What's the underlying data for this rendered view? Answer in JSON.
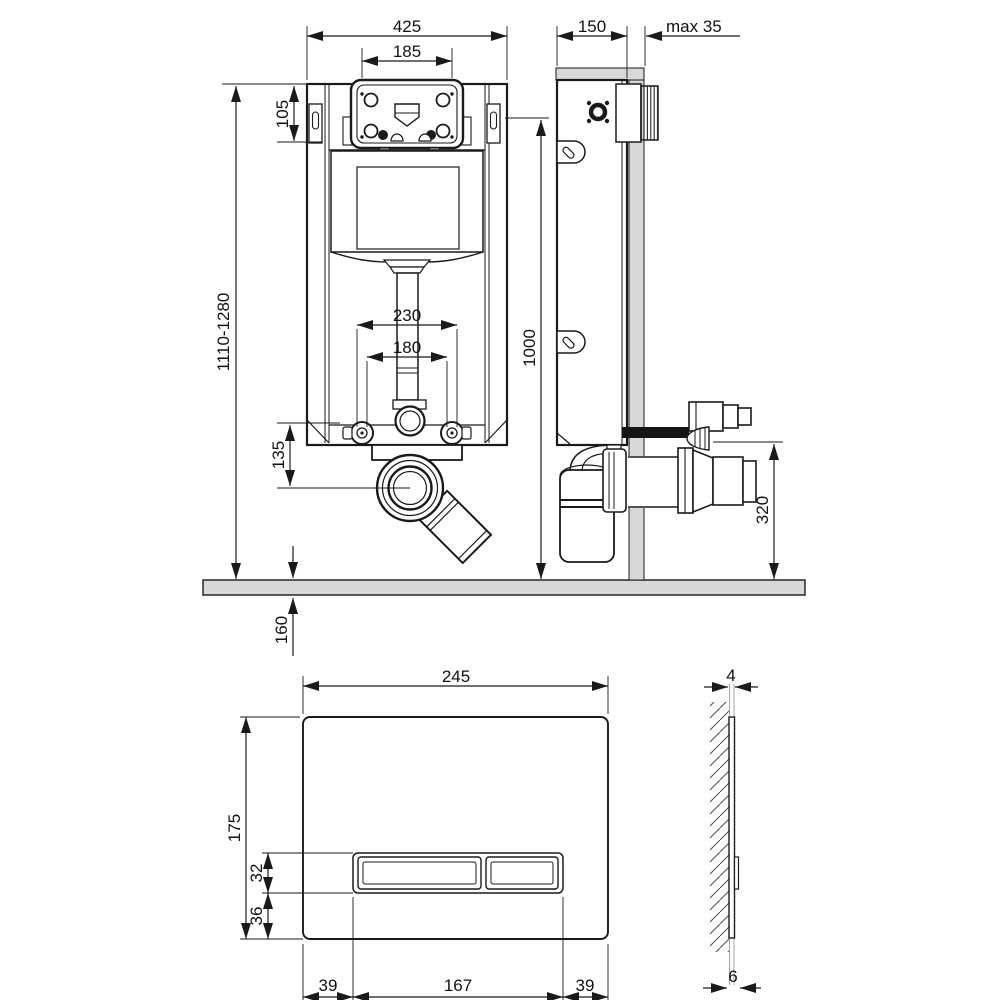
{
  "drawing": {
    "type": "installation technical drawing, concealed WC cistern frame with flush plate",
    "front_view": {
      "frame_width": "425",
      "inspection_box_width": "185",
      "inspection_box_height": "105",
      "frame_height_range": "1110-1280",
      "outlet_spacing_outer": "230",
      "outlet_spacing_inner": "180",
      "outlet_center_height": "135",
      "below_floor_depth": "160"
    },
    "side_view": {
      "frame_depth": "150",
      "wall_finish_max": "max 35",
      "actuation_height": "1000",
      "waste_connection_height": "320"
    },
    "plate_front_view": {
      "plate_width": "245",
      "plate_height": "175",
      "button_height": "32",
      "button_bottom_offset": "36",
      "margin_left": "39",
      "buttons_span": "167",
      "margin_right": "39"
    },
    "plate_side_view": {
      "panel_thickness": "4",
      "total_depth": "6"
    },
    "colors": {
      "line": "#1a1a1a",
      "wall_fill": "#d8d8d8",
      "background": "#ffffff"
    }
  }
}
